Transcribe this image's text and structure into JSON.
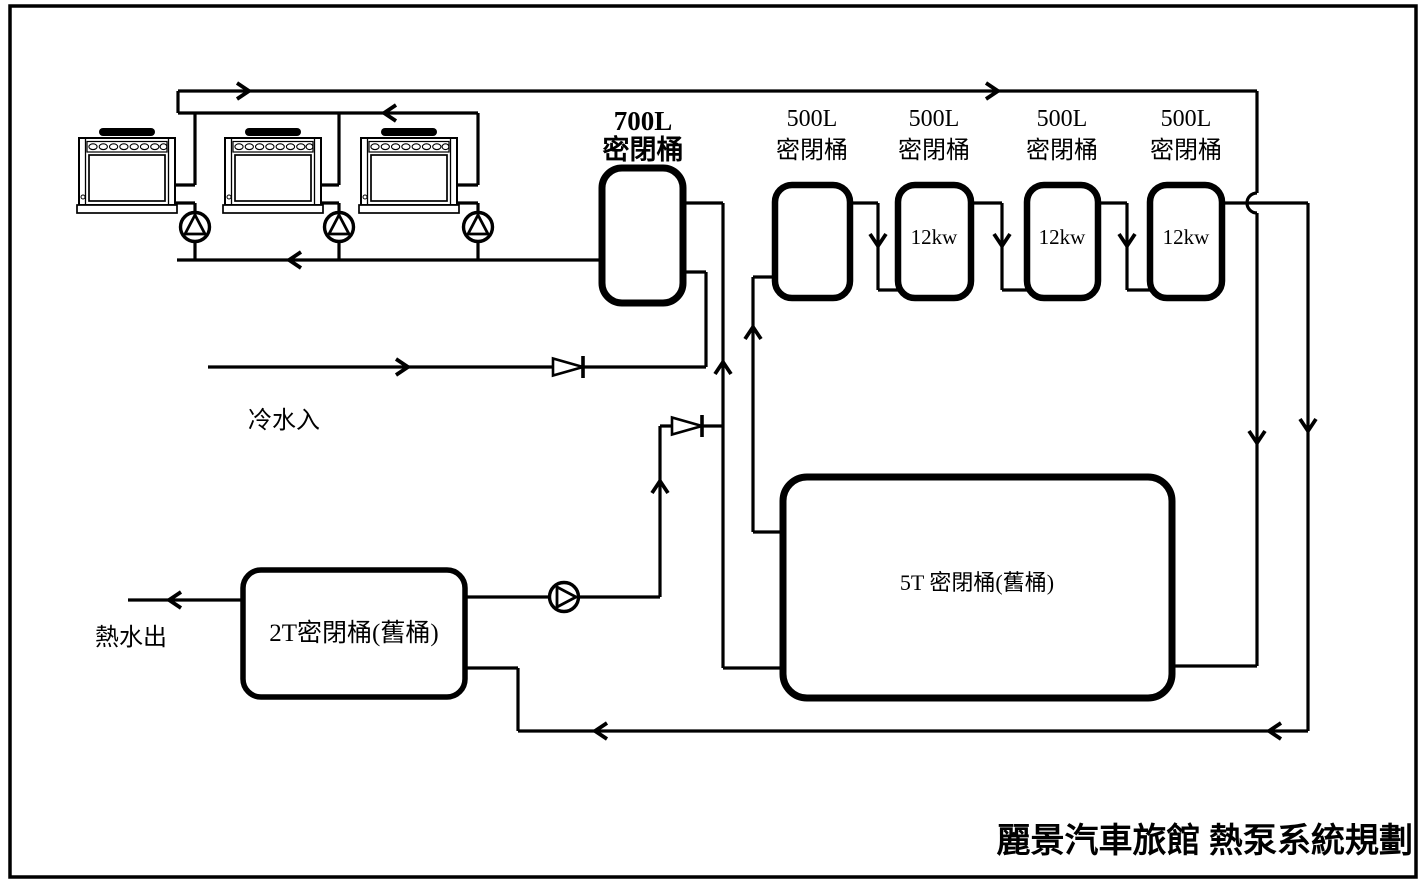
{
  "labels": {
    "tank_700": {
      "capacity": "700L",
      "type": "密閉桶"
    },
    "tank_500": {
      "capacity": "500L",
      "type": "密閉桶"
    },
    "heater_power": "12kw",
    "tank_5t": "5T 密閉桶(舊桶)",
    "tank_2t": "2T密閉桶(舊桶)",
    "cold_water_in": "冷水入",
    "hot_water_out": "熱水出",
    "title": "麗景汽車旅館 熱泵系統規劃"
  },
  "equipment": {
    "heat_pump_count": 3,
    "closed_tank_500L_count": 4,
    "heater_12kw_count": 3
  },
  "colors": {
    "line": "#000000",
    "background": "#ffffff"
  }
}
